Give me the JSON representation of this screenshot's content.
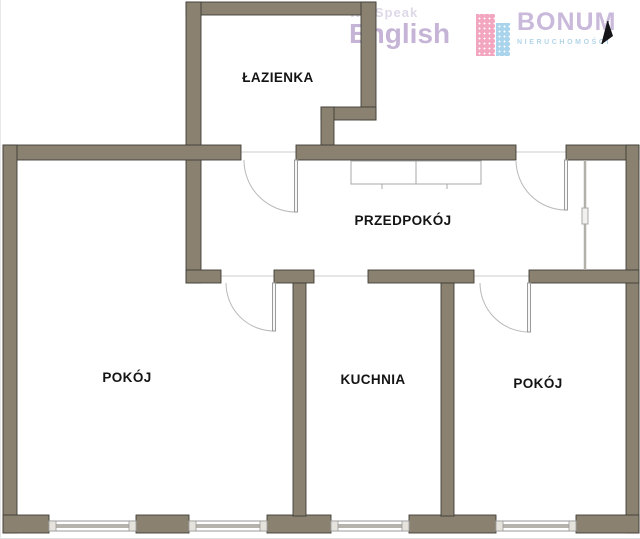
{
  "branding": {
    "english_school": {
      "line1": "We Speak",
      "line2": "English"
    },
    "agency": {
      "name": "BONUM",
      "subtitle": "NIERUCHOMOŚCI"
    }
  },
  "icons": {
    "north_arrow": "north-arrow",
    "buildings_logo": "buildings-icon"
  },
  "rooms": [
    {
      "id": "lazienka",
      "label": "ŁAZIENKA"
    },
    {
      "id": "przedpokoj",
      "label": "PRZEDPOKÓJ"
    },
    {
      "id": "pokoj-left",
      "label": "POKÓJ"
    },
    {
      "id": "kuchnia",
      "label": "KUCHNIA"
    },
    {
      "id": "pokoj-right",
      "label": "POKÓJ"
    }
  ],
  "plan_features": {
    "windows": 4,
    "hinged_doors": 4,
    "open_passages": 1,
    "wardrobes": 2
  },
  "colors": {
    "wall_fill": "#8a8171",
    "wall_outline": "#3f3e35",
    "logo_purple": "#c6b4d6",
    "logo_pink": "#f2a6c0",
    "logo_blue": "#a9d4ec",
    "subtitle_blue": "#b3d4e8"
  }
}
